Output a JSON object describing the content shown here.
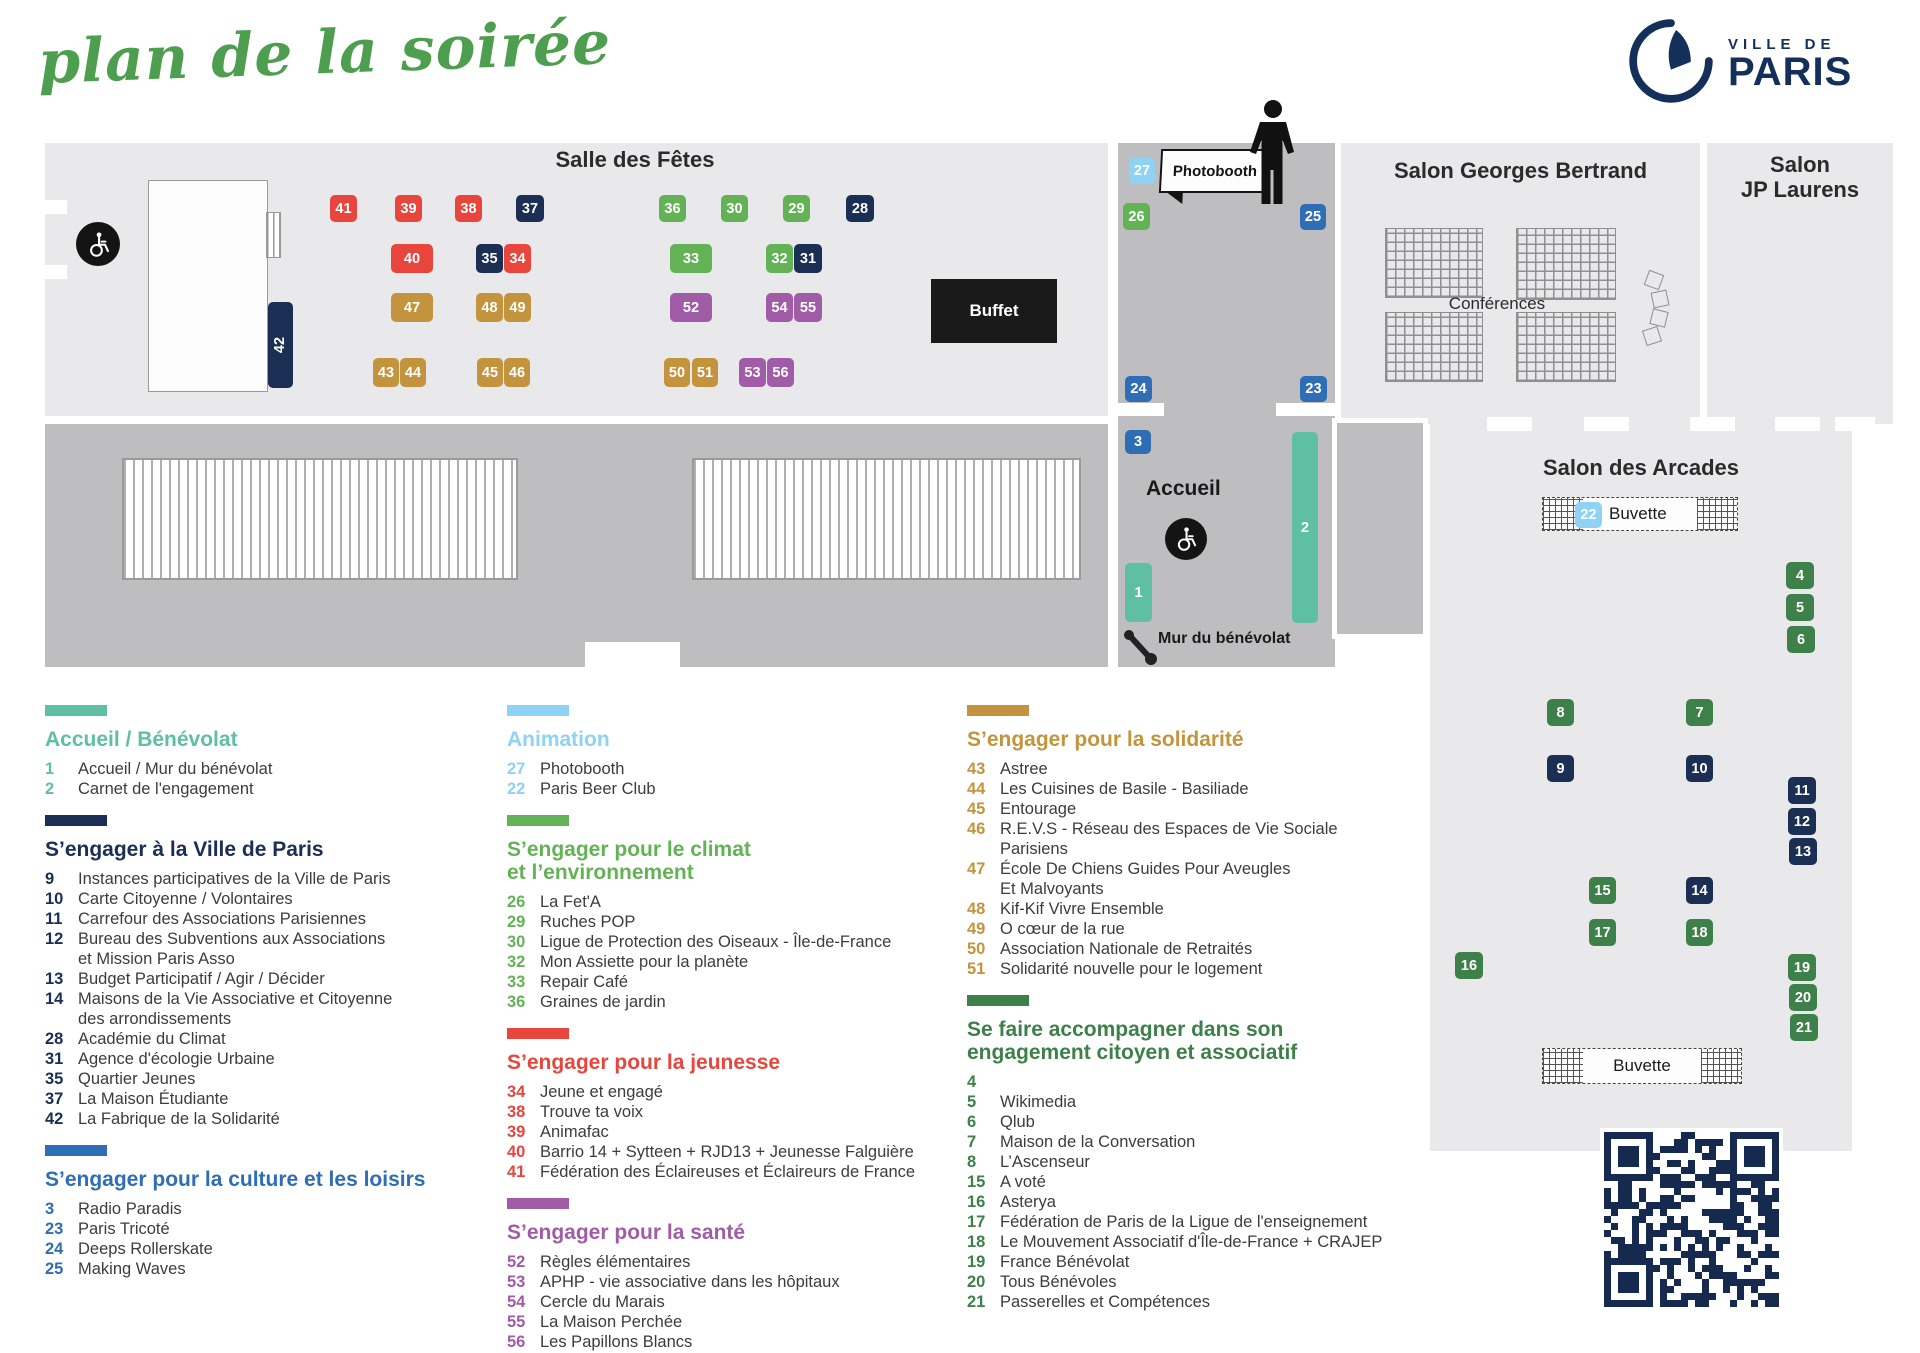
{
  "title": "plan de la soirée",
  "logo": {
    "top": "VILLE DE",
    "bottom": "PARIS"
  },
  "colors": {
    "teal": "#5FBFA2",
    "navy": "#1B2F55",
    "blue": "#2F6DB5",
    "lightblue": "#8ED2F4",
    "green": "#63B356",
    "dgreen": "#3E8049",
    "red": "#E8453D",
    "gold": "#C3943D",
    "purple": "#A05CA6"
  },
  "map": {
    "rooms": {
      "salle": "Salle des Fêtes",
      "georges": "Salon Georges Bertrand",
      "jp": "Salon\nJP Laurens",
      "arcades": "Salon des Arcades",
      "conferences": "Conférences",
      "accueil": "Accueil",
      "buffet": "Buffet",
      "photobooth": "Photobooth",
      "mur": "Mur du bénévolat",
      "buvette": "Buvette",
      "buvette_badge": "22"
    },
    "booths": [
      {
        "n": "41",
        "cat": "red",
        "x": 330,
        "y": 195,
        "w": 27,
        "h": 27
      },
      {
        "n": "39",
        "cat": "red",
        "x": 395,
        "y": 195,
        "w": 27,
        "h": 27
      },
      {
        "n": "38",
        "cat": "red",
        "x": 455,
        "y": 195,
        "w": 27,
        "h": 27
      },
      {
        "n": "37",
        "cat": "navy",
        "x": 516,
        "y": 195,
        "w": 28,
        "h": 27
      },
      {
        "n": "36",
        "cat": "green",
        "x": 659,
        "y": 195,
        "w": 27,
        "h": 27
      },
      {
        "n": "30",
        "cat": "green",
        "x": 721,
        "y": 195,
        "w": 27,
        "h": 27
      },
      {
        "n": "29",
        "cat": "green",
        "x": 783,
        "y": 195,
        "w": 27,
        "h": 27
      },
      {
        "n": "28",
        "cat": "navy",
        "x": 846,
        "y": 195,
        "w": 28,
        "h": 27
      },
      {
        "n": "40",
        "cat": "red",
        "x": 391,
        "y": 244,
        "w": 42,
        "h": 29
      },
      {
        "n": "35",
        "cat": "navy",
        "x": 476,
        "y": 244,
        "w": 27,
        "h": 29
      },
      {
        "n": "34",
        "cat": "red",
        "x": 504,
        "y": 244,
        "w": 27,
        "h": 29
      },
      {
        "n": "33",
        "cat": "green",
        "x": 670,
        "y": 244,
        "w": 42,
        "h": 29
      },
      {
        "n": "32",
        "cat": "green",
        "x": 766,
        "y": 244,
        "w": 27,
        "h": 29
      },
      {
        "n": "31",
        "cat": "navy",
        "x": 794,
        "y": 244,
        "w": 28,
        "h": 29
      },
      {
        "n": "47",
        "cat": "gold",
        "x": 391,
        "y": 293,
        "w": 42,
        "h": 29
      },
      {
        "n": "48",
        "cat": "gold",
        "x": 476,
        "y": 293,
        "w": 27,
        "h": 29
      },
      {
        "n": "49",
        "cat": "gold",
        "x": 504,
        "y": 293,
        "w": 27,
        "h": 29
      },
      {
        "n": "52",
        "cat": "purple",
        "x": 670,
        "y": 293,
        "w": 42,
        "h": 29
      },
      {
        "n": "54",
        "cat": "purple",
        "x": 766,
        "y": 293,
        "w": 27,
        "h": 29
      },
      {
        "n": "55",
        "cat": "purple",
        "x": 794,
        "y": 293,
        "w": 28,
        "h": 29
      },
      {
        "n": "43",
        "cat": "gold",
        "x": 373,
        "y": 358,
        "w": 26,
        "h": 29
      },
      {
        "n": "44",
        "cat": "gold",
        "x": 400,
        "y": 358,
        "w": 26,
        "h": 29
      },
      {
        "n": "45",
        "cat": "gold",
        "x": 477,
        "y": 358,
        "w": 26,
        "h": 29
      },
      {
        "n": "46",
        "cat": "gold",
        "x": 504,
        "y": 358,
        "w": 26,
        "h": 29
      },
      {
        "n": "50",
        "cat": "gold",
        "x": 664,
        "y": 358,
        "w": 26,
        "h": 29
      },
      {
        "n": "51",
        "cat": "gold",
        "x": 692,
        "y": 358,
        "w": 26,
        "h": 29
      },
      {
        "n": "53",
        "cat": "purple",
        "x": 739,
        "y": 358,
        "w": 27,
        "h": 29
      },
      {
        "n": "56",
        "cat": "purple",
        "x": 767,
        "y": 358,
        "w": 27,
        "h": 29
      },
      {
        "n": "42",
        "cat": "navy",
        "x": 268,
        "y": 302,
        "w": 25,
        "h": 86,
        "rot": true
      },
      {
        "n": "27",
        "cat": "lightblue",
        "x": 1129,
        "y": 158,
        "w": 26,
        "h": 26
      },
      {
        "n": "26",
        "cat": "green",
        "x": 1123,
        "y": 203,
        "w": 27,
        "h": 27
      },
      {
        "n": "25",
        "cat": "blue",
        "x": 1300,
        "y": 204,
        "w": 26,
        "h": 26
      },
      {
        "n": "24",
        "cat": "blue",
        "x": 1125,
        "y": 376,
        "w": 27,
        "h": 26
      },
      {
        "n": "23",
        "cat": "blue",
        "x": 1300,
        "y": 376,
        "w": 27,
        "h": 26
      },
      {
        "n": "3",
        "cat": "blue",
        "x": 1125,
        "y": 430,
        "w": 26,
        "h": 24
      },
      {
        "n": "1",
        "cat": "teal",
        "x": 1125,
        "y": 563,
        "w": 27,
        "h": 59
      },
      {
        "n": "2",
        "cat": "teal",
        "x": 1292,
        "y": 432,
        "w": 26,
        "h": 191
      },
      {
        "n": "4",
        "cat": "dgreen",
        "x": 1786,
        "y": 562,
        "w": 28,
        "h": 27
      },
      {
        "n": "5",
        "cat": "dgreen",
        "x": 1786,
        "y": 594,
        "w": 28,
        "h": 27
      },
      {
        "n": "6",
        "cat": "dgreen",
        "x": 1787,
        "y": 626,
        "w": 28,
        "h": 27
      },
      {
        "n": "8",
        "cat": "dgreen",
        "x": 1547,
        "y": 699,
        "w": 27,
        "h": 27
      },
      {
        "n": "7",
        "cat": "dgreen",
        "x": 1686,
        "y": 699,
        "w": 27,
        "h": 27
      },
      {
        "n": "9",
        "cat": "navy",
        "x": 1547,
        "y": 755,
        "w": 27,
        "h": 27
      },
      {
        "n": "10",
        "cat": "navy",
        "x": 1686,
        "y": 755,
        "w": 27,
        "h": 27
      },
      {
        "n": "11",
        "cat": "navy",
        "x": 1788,
        "y": 777,
        "w": 28,
        "h": 27
      },
      {
        "n": "12",
        "cat": "navy",
        "x": 1788,
        "y": 808,
        "w": 28,
        "h": 27
      },
      {
        "n": "13",
        "cat": "navy",
        "x": 1789,
        "y": 838,
        "w": 28,
        "h": 27
      },
      {
        "n": "15",
        "cat": "dgreen",
        "x": 1589,
        "y": 877,
        "w": 27,
        "h": 27
      },
      {
        "n": "14",
        "cat": "navy",
        "x": 1686,
        "y": 877,
        "w": 27,
        "h": 27
      },
      {
        "n": "17",
        "cat": "dgreen",
        "x": 1589,
        "y": 919,
        "w": 27,
        "h": 27
      },
      {
        "n": "18",
        "cat": "dgreen",
        "x": 1686,
        "y": 919,
        "w": 27,
        "h": 27
      },
      {
        "n": "16",
        "cat": "dgreen",
        "x": 1455,
        "y": 952,
        "w": 28,
        "h": 27
      },
      {
        "n": "19",
        "cat": "dgreen",
        "x": 1788,
        "y": 954,
        "w": 28,
        "h": 27
      },
      {
        "n": "20",
        "cat": "dgreen",
        "x": 1789,
        "y": 984,
        "w": 28,
        "h": 27
      },
      {
        "n": "21",
        "cat": "dgreen",
        "x": 1790,
        "y": 1014,
        "w": 28,
        "h": 27
      }
    ]
  },
  "legend": {
    "columns": [
      {
        "sections": [
          {
            "color": "teal",
            "heading": "Accueil / Bénévolat",
            "items": [
              {
                "n": "1",
                "label": "Accueil / Mur du bénévolat"
              },
              {
                "n": "2",
                "label": "Carnet de l'engagement"
              }
            ]
          },
          {
            "color": "navy",
            "heading": "S’engager à la Ville de Paris",
            "items": [
              {
                "n": "9",
                "label": "Instances participatives de la Ville de Paris"
              },
              {
                "n": "10",
                "label": "Carte Citoyenne / Volontaires"
              },
              {
                "n": "11",
                "label": "Carrefour des Associations Parisiennes"
              },
              {
                "n": "12",
                "label": "Bureau des Subventions aux Associations\net Mission Paris Asso"
              },
              {
                "n": "13",
                "label": "Budget Participatif / Agir / Décider"
              },
              {
                "n": "14",
                "label": "Maisons de la Vie Associative et Citoyenne\ndes arrondissements"
              },
              {
                "n": "28",
                "label": "Académie du Climat"
              },
              {
                "n": "31",
                "label": "Agence d'écologie Urbaine"
              },
              {
                "n": "35",
                "label": "Quartier Jeunes"
              },
              {
                "n": "37",
                "label": "La Maison Étudiante"
              },
              {
                "n": "42",
                "label": "La Fabrique de la Solidarité"
              }
            ]
          },
          {
            "color": "blue",
            "heading": "S’engager pour la culture et les loisirs",
            "items": [
              {
                "n": "3",
                "label": "Radio Paradis"
              },
              {
                "n": "23",
                "label": "Paris Tricoté"
              },
              {
                "n": "24",
                "label": "Deeps Rollerskate"
              },
              {
                "n": "25",
                "label": "Making Waves"
              }
            ]
          }
        ]
      },
      {
        "sections": [
          {
            "color": "lightblue",
            "heading": "Animation",
            "items": [
              {
                "n": "27",
                "label": "Photobooth"
              },
              {
                "n": "22",
                "label": "Paris Beer Club"
              }
            ]
          },
          {
            "color": "green",
            "heading": "S’engager pour le climat\net l’environnement",
            "items": [
              {
                "n": "26",
                "label": "La Fet'A"
              },
              {
                "n": "29",
                "label": "Ruches POP"
              },
              {
                "n": "30",
                "label": "Ligue de Protection des Oiseaux - Île-de-France"
              },
              {
                "n": "32",
                "label": "Mon Assiette pour la planète"
              },
              {
                "n": "33",
                "label": "Repair Café"
              },
              {
                "n": "36",
                "label": "Graines de jardin"
              }
            ]
          },
          {
            "color": "red",
            "heading": "S’engager pour la jeunesse",
            "items": [
              {
                "n": "34",
                "label": "Jeune et engagé"
              },
              {
                "n": "38",
                "label": "Trouve ta voix"
              },
              {
                "n": "39",
                "label": "Animafac"
              },
              {
                "n": "40",
                "label": "Barrio 14 + Sytteen + RJD13 + Jeunesse Falguière"
              },
              {
                "n": "41",
                "label": "Fédération des Éclaireuses et Éclaireurs de France"
              }
            ]
          },
          {
            "color": "purple",
            "heading": "S’engager pour la santé",
            "items": [
              {
                "n": "52",
                "label": "Règles élémentaires"
              },
              {
                "n": "53",
                "label": "APHP - vie associative dans les hôpitaux"
              },
              {
                "n": "54",
                "label": "Cercle du Marais"
              },
              {
                "n": "55",
                "label": "La Maison Perchée"
              },
              {
                "n": "56",
                "label": "Les Papillons Blancs"
              }
            ]
          }
        ]
      },
      {
        "sections": [
          {
            "color": "gold",
            "heading": "S’engager pour la solidarité",
            "items": [
              {
                "n": "43",
                "label": "Astree"
              },
              {
                "n": "44",
                "label": "Les Cuisines de Basile - Basiliade"
              },
              {
                "n": "45",
                "label": "Entourage"
              },
              {
                "n": "46",
                "label": "R.E.V.S - Réseau des Espaces de Vie Sociale\nParisiens"
              },
              {
                "n": "47",
                "label": "École De Chiens Guides Pour Aveugles\nEt Malvoyants"
              },
              {
                "n": "48",
                "label": "Kif-Kif Vivre Ensemble"
              },
              {
                "n": "49",
                "label": "O cœur de la rue"
              },
              {
                "n": "50",
                "label": "Association Nationale de Retraités"
              },
              {
                "n": "51",
                "label": "Solidarité nouvelle pour le logement"
              }
            ]
          },
          {
            "color": "dgreen",
            "heading": "Se faire accompagner dans son\nengagement citoyen et associatif",
            "items": [
              {
                "n": "4",
                "label": ""
              },
              {
                "n": "5",
                "label": "Wikimedia"
              },
              {
                "n": "6",
                "label": "Qlub"
              },
              {
                "n": "7",
                "label": "Maison de la Conversation"
              },
              {
                "n": "8",
                "label": "L’Ascenseur"
              },
              {
                "n": "15",
                "label": "A voté"
              },
              {
                "n": "16",
                "label": "Asterya"
              },
              {
                "n": "17",
                "label": "Fédération de Paris de la Ligue de l'enseignement"
              },
              {
                "n": "18",
                "label": "Le Mouvement Associatif d'Île-de-France + CRAJEP"
              },
              {
                "n": "19",
                "label": "France Bénévolat"
              },
              {
                "n": "20",
                "label": "Tous Bénévoles"
              },
              {
                "n": "21",
                "label": "Passerelles et Compétences"
              }
            ]
          }
        ]
      }
    ]
  }
}
